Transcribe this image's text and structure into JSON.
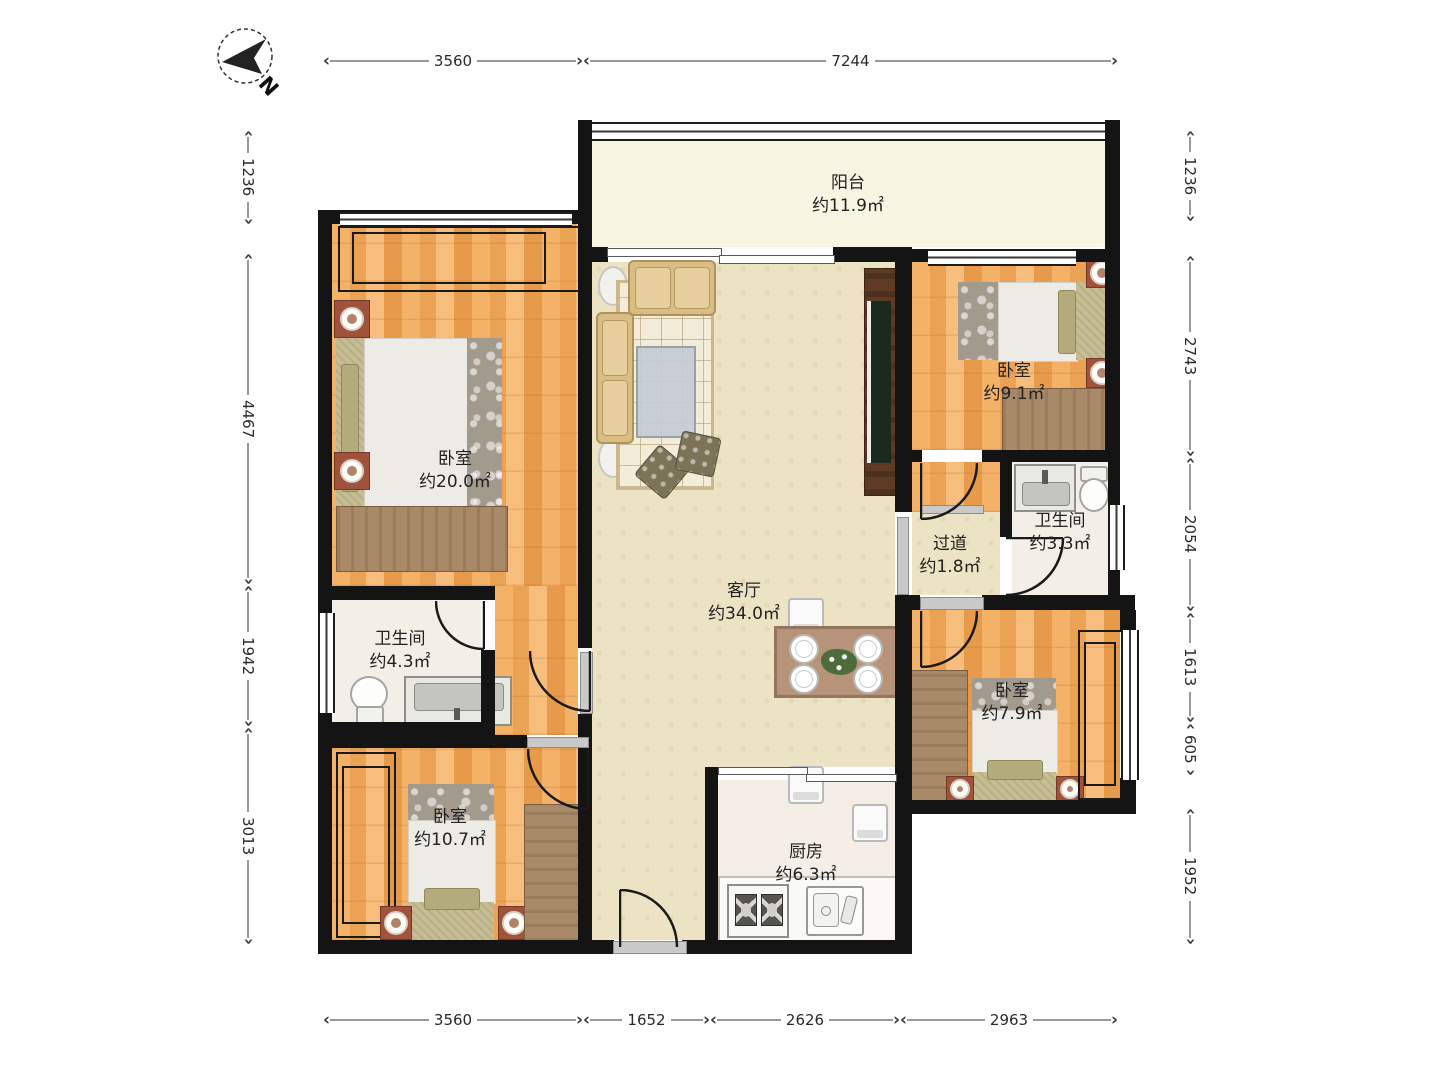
{
  "compass": {
    "label": "N"
  },
  "rooms": {
    "balcony": {
      "name": "阳台",
      "area": "约11.9㎡"
    },
    "bedroom_master": {
      "name": "卧室",
      "area": "约20.0㎡"
    },
    "bedroom_top_right": {
      "name": "卧室",
      "area": "约9.1㎡"
    },
    "bathroom_right": {
      "name": "卫生间",
      "area": "约3.3㎡"
    },
    "hallway": {
      "name": "过道",
      "area": "约1.8㎡"
    },
    "living_room": {
      "name": "客厅",
      "area": "约34.0㎡"
    },
    "bathroom_left": {
      "name": "卫生间",
      "area": "约4.3㎡"
    },
    "bedroom_bottom_left": {
      "name": "卧室",
      "area": "约10.7㎡"
    },
    "kitchen": {
      "name": "厨房",
      "area": "约6.3㎡"
    },
    "bedroom_bottom_right": {
      "name": "卧室",
      "area": "约7.9㎡"
    }
  },
  "dimensions": {
    "top": [
      "3560",
      "7244"
    ],
    "bottom": [
      "3560",
      "1652",
      "2626",
      "2963"
    ],
    "left": [
      "1236",
      "4467",
      "1942",
      "3013"
    ],
    "right": [
      "1236",
      "2743",
      "2054",
      "1613",
      "605",
      "1952"
    ]
  },
  "colors": {
    "wall": "#141414",
    "living_floor": "#ece3c4",
    "balcony_floor": "#f6f6e3",
    "bath_floor": "#f3efe7",
    "kitchen_floor": "#f4eee6",
    "wood_floor": "#eda75f",
    "dimension_line": "#999999",
    "label_text": "#222222"
  }
}
